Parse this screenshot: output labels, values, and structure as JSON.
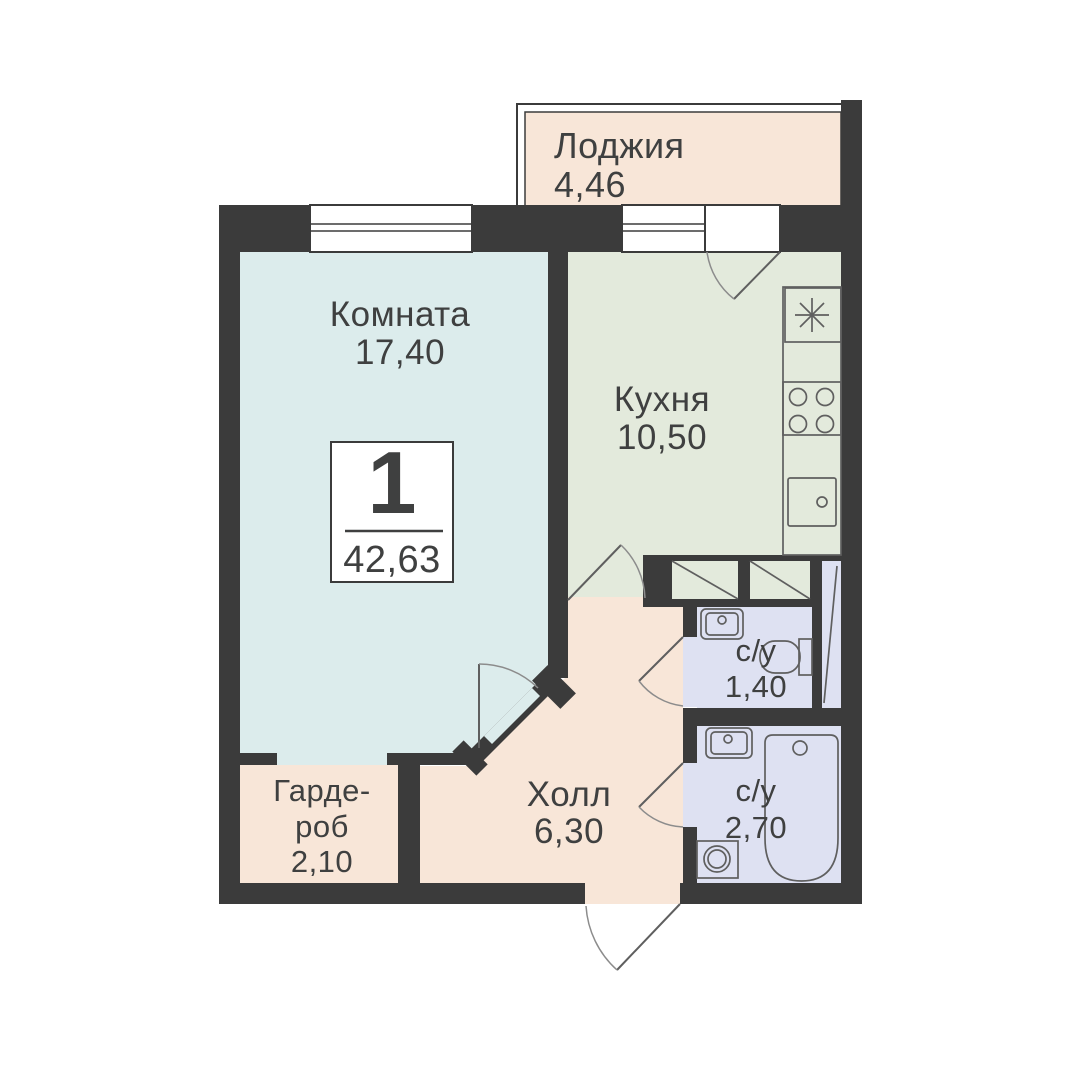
{
  "badge": {
    "rooms_count": "1",
    "total_area": "42,63"
  },
  "rooms": {
    "loggia": {
      "label": "Лоджия",
      "area": "4,46"
    },
    "living": {
      "label": "Комната",
      "area": "17,40"
    },
    "kitchen": {
      "label": "Кухня",
      "area": "10,50"
    },
    "bath_small": {
      "label": "с/у",
      "area": "1,40"
    },
    "bath_large": {
      "label": "с/у",
      "area": "2,70"
    },
    "hall": {
      "label": "Холл",
      "area": "6,30"
    },
    "wardrobe": {
      "label_line_1": "Гарде-",
      "label_line_2": "роб",
      "area": "2,10"
    }
  },
  "colors": {
    "background": "#ffffff",
    "wall": "#3b3b3b",
    "living": "#dcecec",
    "kitchen": "#e3eadc",
    "service": "#f8e6d8",
    "bathroom": "#dee1f2",
    "fixture_stroke": "#5f5f5f",
    "door_stroke": "#8c8c8c",
    "text": "#3f4040"
  }
}
